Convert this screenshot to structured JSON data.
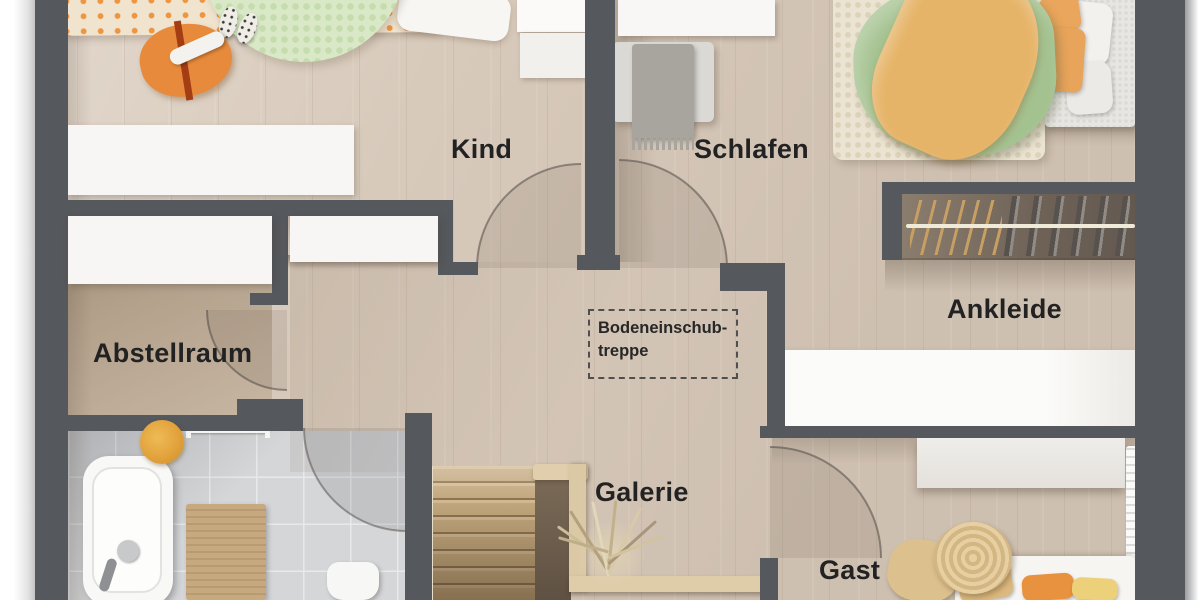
{
  "rooms": {
    "kind": {
      "label": "Kind"
    },
    "schlafen": {
      "label": "Schlafen"
    },
    "abstellraum": {
      "label": "Abstellraum"
    },
    "ankleide": {
      "label": "Ankleide"
    },
    "galerie": {
      "label": "Galerie"
    },
    "gast": {
      "label": "Gast"
    }
  },
  "annotation": {
    "line1": "Bodeneinschub-",
    "line2": "treppe"
  },
  "objects": [
    "child-bed",
    "round-rug",
    "floor-cushion",
    "slippers",
    "wall-shelf-desk",
    "double-bed",
    "bedside-rug",
    "bench-with-blanket",
    "wall-cabinets",
    "clothes-rail-with-hangers",
    "wardrobe",
    "sideboard",
    "radiator",
    "woven-pouf",
    "guest-bed",
    "staircase",
    "stair-railing",
    "dried-plant",
    "bathtub",
    "bath-mat",
    "toilet",
    "towel-rail",
    "towel"
  ],
  "colors": {
    "wall": "#55585c",
    "floor_wood": "#d8cabb",
    "floor_dark": "#b3a18c",
    "tile": "#d5d6d8",
    "accent_orange": "#e8913f",
    "accent_green": "#a4c290",
    "accent_yellow": "#e6b468",
    "rug_green": "#d9e8c6",
    "stair_wood": "#c3a87e",
    "furniture_white": "#f7f6f4",
    "label": "#222222"
  }
}
